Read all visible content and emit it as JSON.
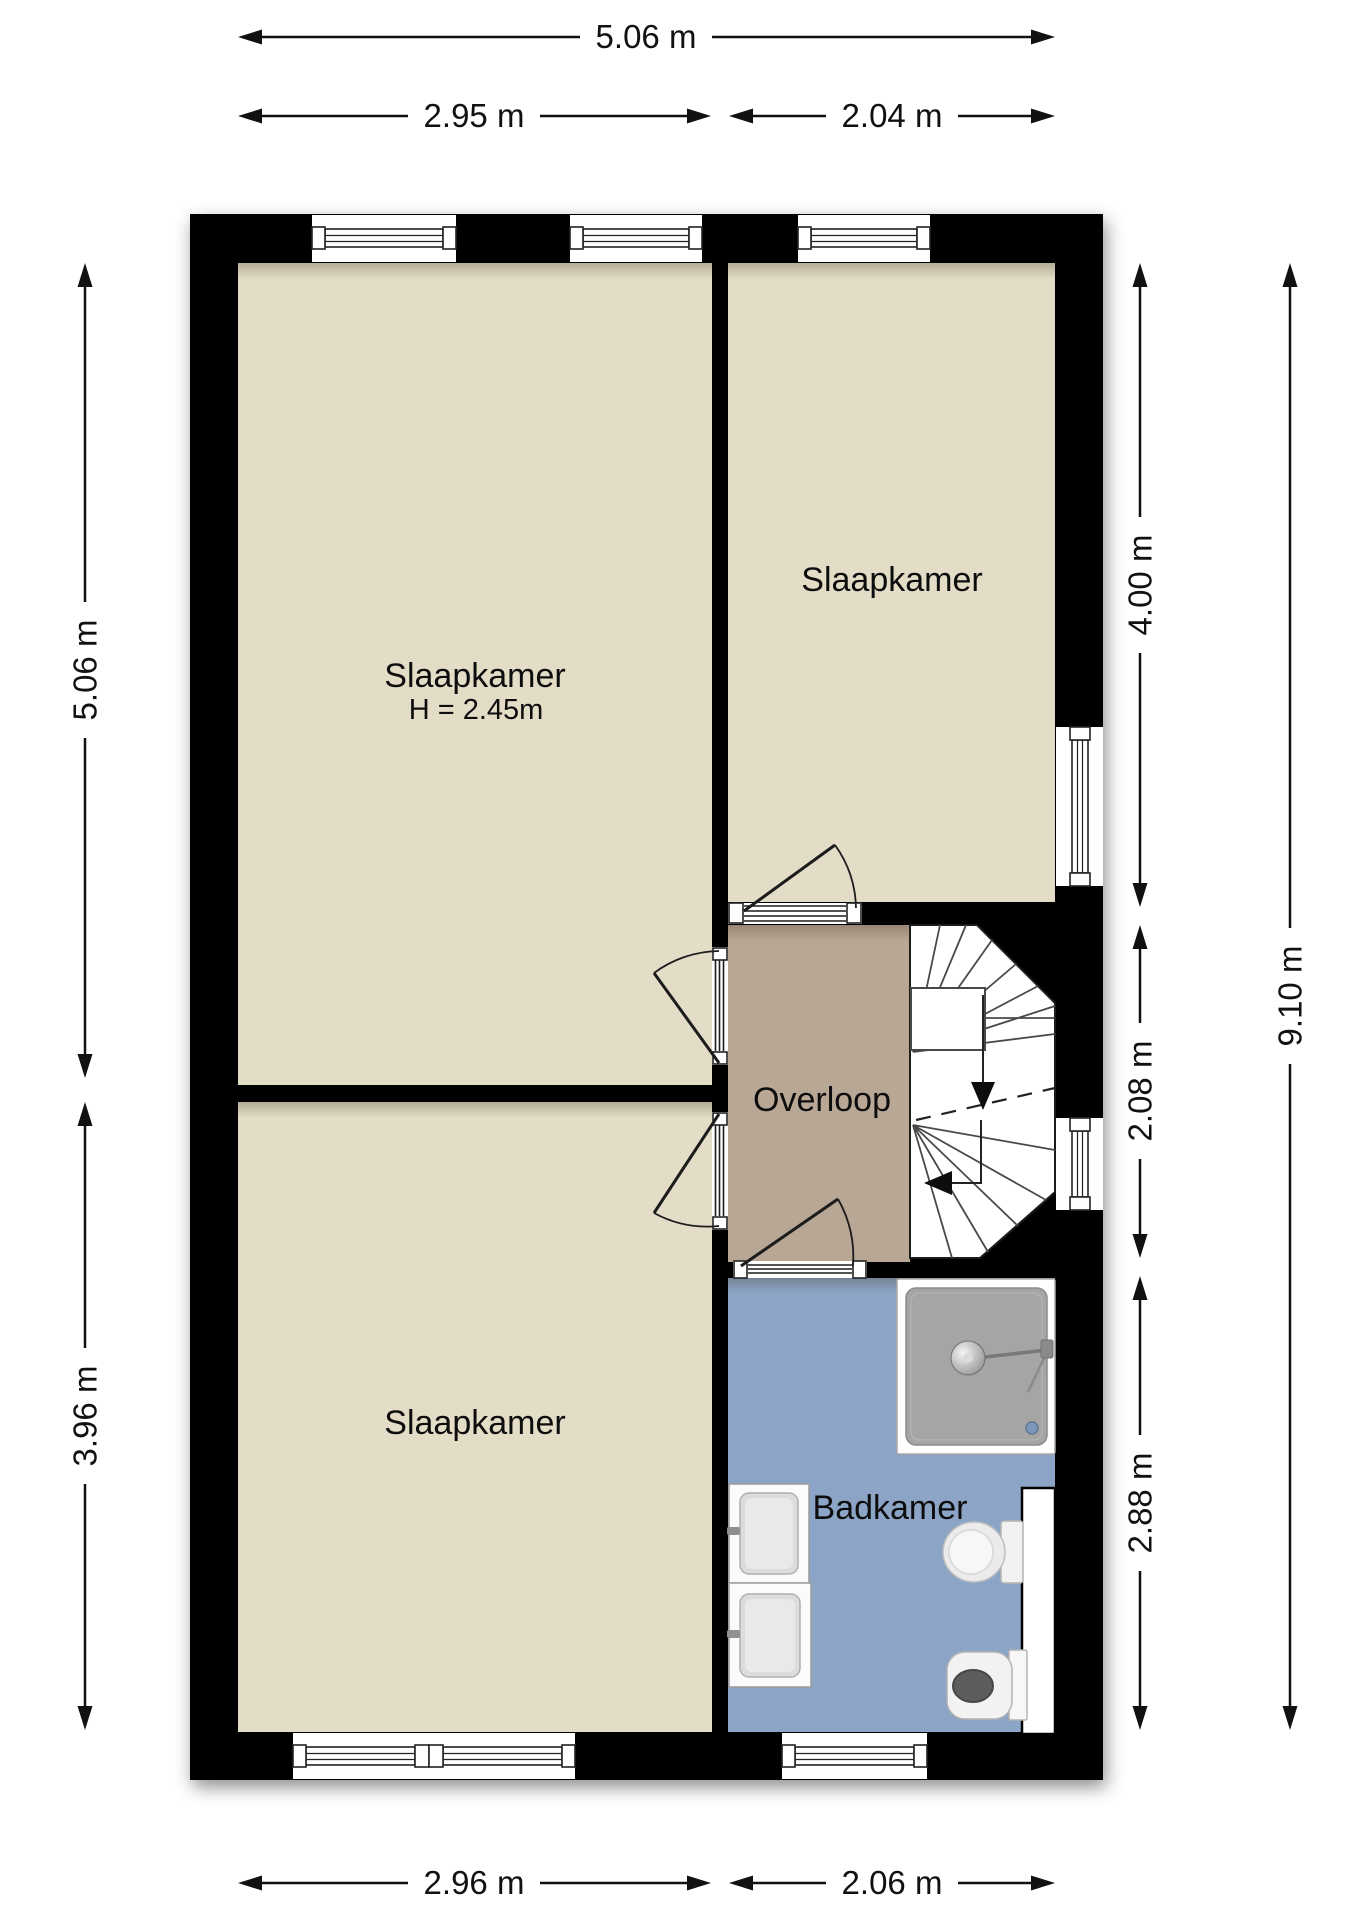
{
  "plan": {
    "type": "floor-plan",
    "rooms": {
      "bedroom_top_left": {
        "name": "Slaapkamer",
        "height_note": "H = 2.45m"
      },
      "bedroom_top_right": {
        "name": "Slaapkamer"
      },
      "bedroom_bottom_left": {
        "name": "Slaapkamer"
      },
      "landing": {
        "name": "Overloop"
      },
      "bathroom": {
        "name": "Badkamer"
      }
    },
    "fixtures": [
      "shower",
      "washbasin",
      "washbasin",
      "toilet",
      "toilet",
      "winder-stairs",
      "duct"
    ]
  },
  "dimensions": {
    "top_total": "5.06 m",
    "top_left": "2.95 m",
    "top_right": "2.04 m",
    "bottom_left": "2.96 m",
    "bottom_right": "2.06 m",
    "left_upper": "5.06 m",
    "left_lower": "3.96 m",
    "right_top": "4.00 m",
    "right_middle": "2.08 m",
    "right_bottom": "2.88 m",
    "right_total": "9.10 m"
  },
  "colors": {
    "wall": "#000000",
    "bedroom_floor": "#e3dcc6",
    "landing_floor": "#b9a795",
    "bathroom_floor": "#8ca5c7",
    "stairs": "#ffffff",
    "fixture_gray": "#a5a5a5",
    "drain_blue": "#7d96b8"
  }
}
